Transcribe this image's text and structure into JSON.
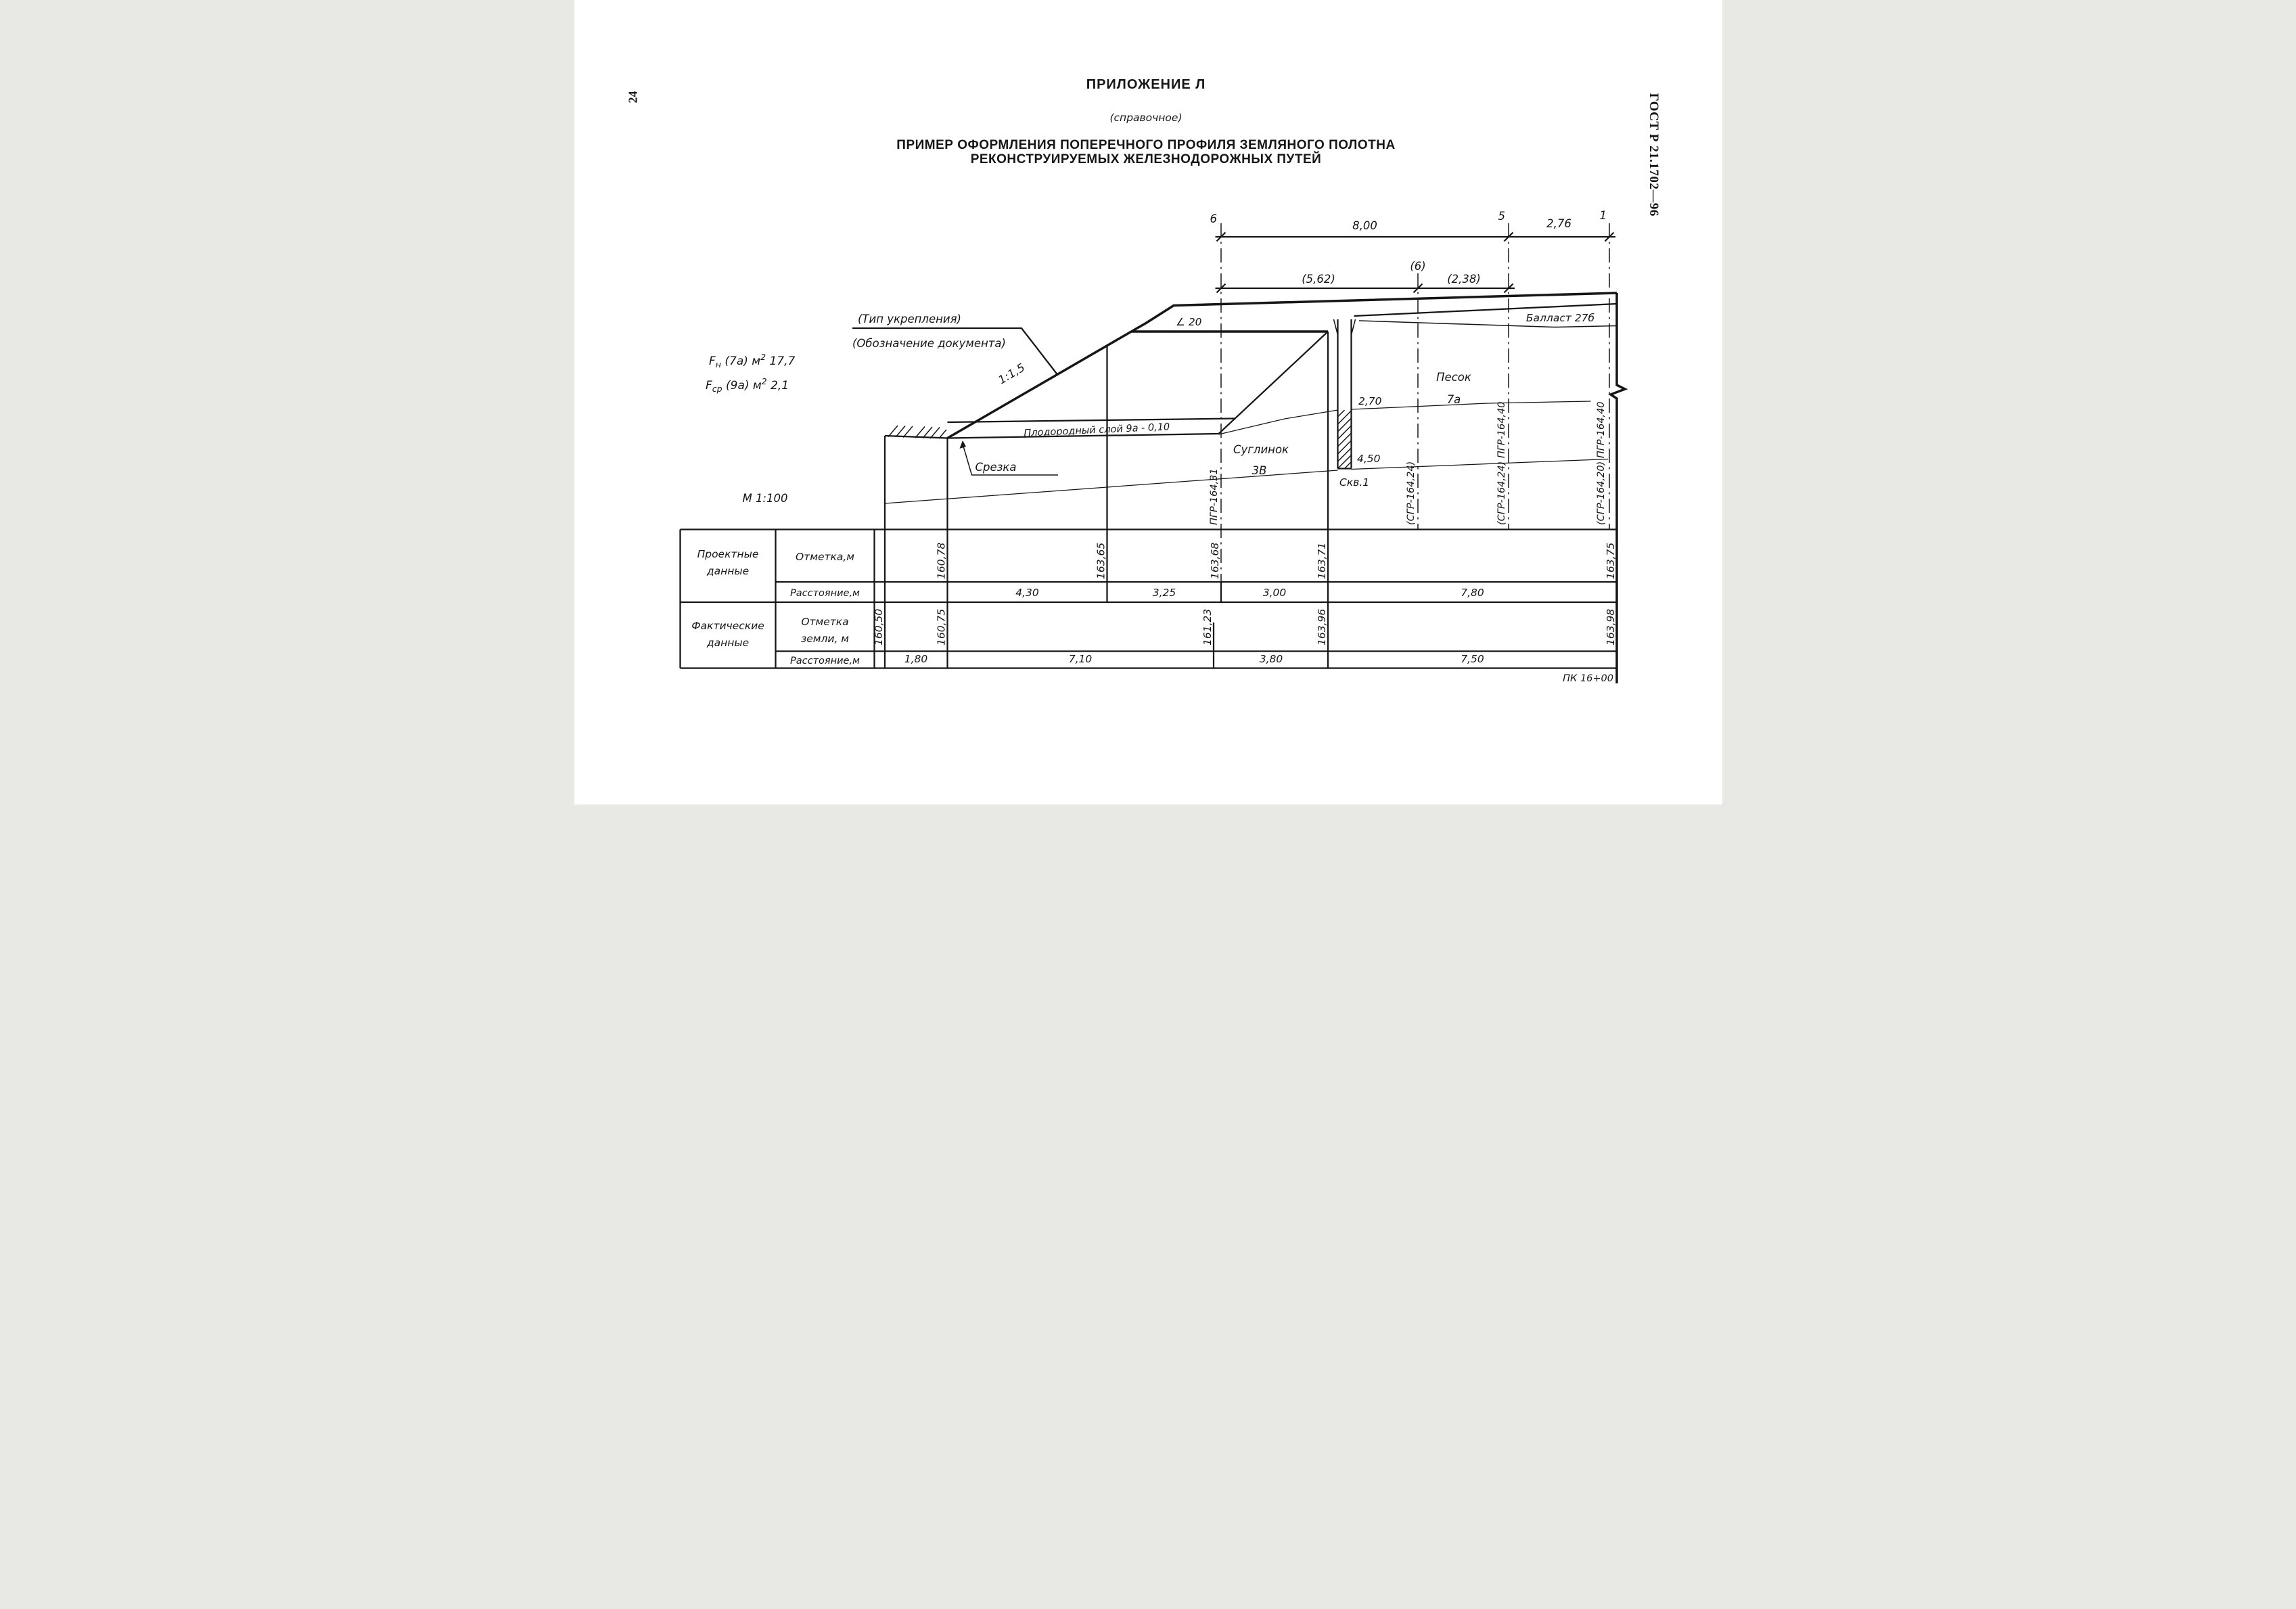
{
  "page": {
    "number": "24",
    "standard_ref": "ГОСТ Р 21.1702—96",
    "appendix": "ПРИЛОЖЕНИЕ Л",
    "appendix_note": "(справочное)",
    "title_line1": "ПРИМЕР ОФОРМЛЕНИЯ ПОПЕРЕЧНОГО ПРОФИЛЯ ЗЕМЛЯНОГО ПОЛОТНА",
    "title_line2": "РЕКОНСТРУИРУЕМЫХ ЖЕЛЕЗНОДОРОЖНЫХ ПУТЕЙ"
  },
  "dimensions": {
    "point_6": "6",
    "point_5": "5",
    "point_1": "1",
    "span_main": "8,00",
    "span_right": "2,76",
    "axis_6_label": "(6)",
    "span_sub_left": "(5,62)",
    "span_sub_right": "(2,38)"
  },
  "annotations": {
    "area_embankment": {
      "f": "F",
      "sub": "н",
      "mid": " (7а)  м",
      "exp": "2",
      "val": " 17,7"
    },
    "area_cut": {
      "f": "F",
      "sub": "ср",
      "mid": " (9а)  м",
      "exp": "2",
      "val": "  2,1"
    },
    "scale": "М 1:100",
    "reinforcement_type": "(Тип укрепления)",
    "document_designation": "(Обозначение документа)",
    "slope_ratio": "1:1,5",
    "grade_sign": "∠ 20",
    "topsoil_layer": "Плодородный   слой 9а - 0,10",
    "cut_label": "Срезка",
    "loam_name": "Суглинок",
    "loam_index": "3В",
    "sand_name": "Песок",
    "sand_index": "7а",
    "ballast": "Балласт 27б",
    "picket": "ПК 16+00"
  },
  "borehole": {
    "name": "Скв.1",
    "depth_upper": "2,70",
    "depth_lower": "4,50"
  },
  "axes": {
    "axis_design": "ПГР-164,31",
    "axis_existing_6": "(СГР-164,24)",
    "axis_5": "(СГР-164,24) ПГР-164,40",
    "axis_1": "(СГР-164,20) ПГР-164,40"
  },
  "table": {
    "group_project_1": "Проектные",
    "group_project_2": "данные",
    "group_fact_1": "Фактические",
    "group_fact_2": "данные",
    "row_mark": "Отметка,м",
    "row_dist": "Расстояние,м",
    "row_mark_ground_1": "Отметка",
    "row_mark_ground_2": "земли, м",
    "row_dist2": "Расстояние,м",
    "project": {
      "elevations": [
        "160,78",
        "163,65",
        "163,68",
        "163,71",
        "163,75"
      ],
      "distances": [
        "4,30",
        "3,25",
        "3,00",
        "7,80"
      ]
    },
    "fact": {
      "elevations": [
        "160,50",
        "160,75",
        "161,23",
        "163,96",
        "163,98"
      ],
      "distances": [
        "1,80",
        "7,10",
        "3,80",
        "7,50"
      ]
    }
  }
}
